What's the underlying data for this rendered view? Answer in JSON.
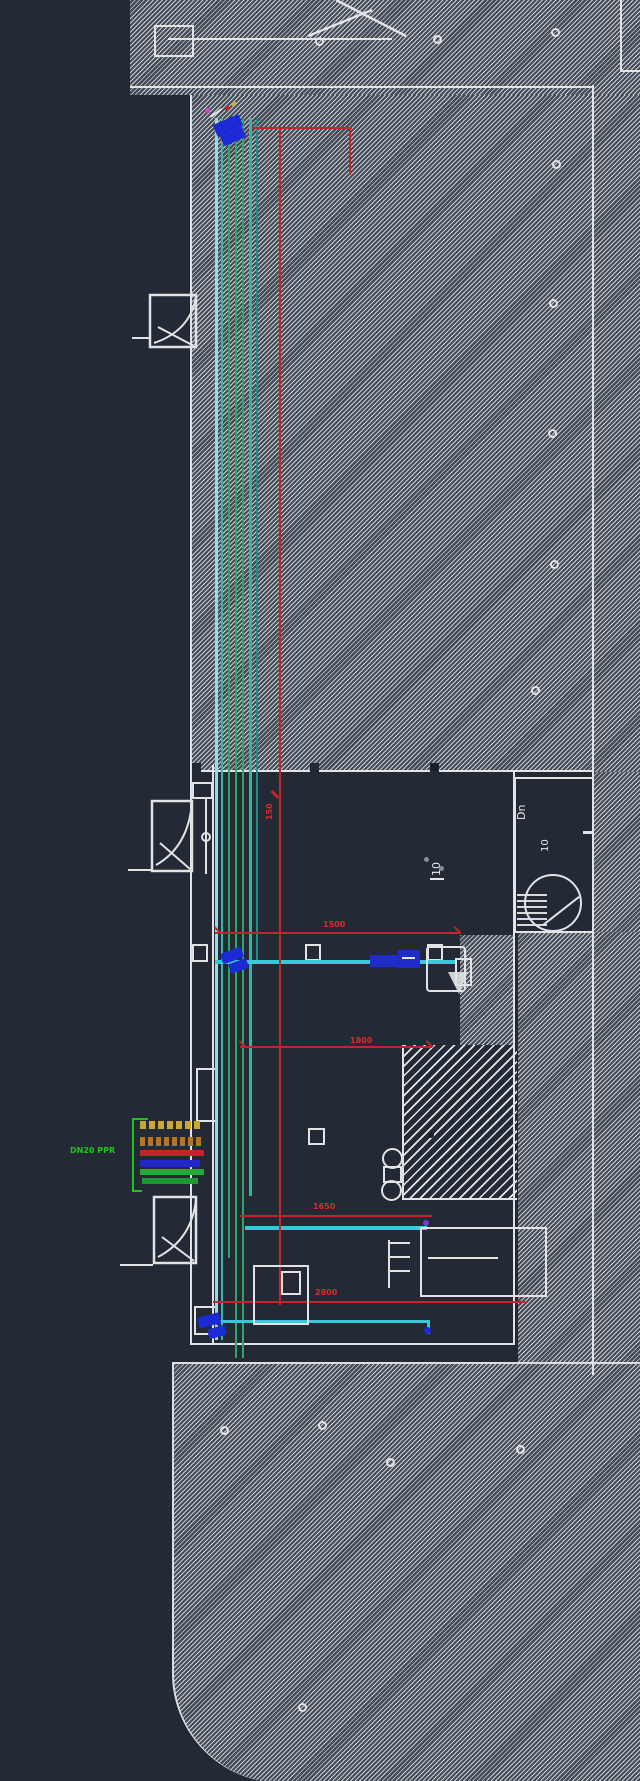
{
  "app": {
    "description": "CAD floor-plan drawing viewport (dark theme)",
    "background": "#232a35"
  },
  "colors": {
    "background": "#232a35",
    "linework_white": "#e2e3e5",
    "dimension_red": "#c3252b",
    "pipe_cyan": "#36c9da",
    "pipe_pale_cyan": "#8fdde8",
    "pipe_green": "#2fa763",
    "pipe_teal": "#2db89f",
    "arrow_blue": "#1b2ad4",
    "callout_green": "#1ec41e",
    "callout_yellow": "#c8a832"
  },
  "labels": {
    "stair_direction": "Dn",
    "stair_flight_count": "10",
    "room_riser_count": "10",
    "pipe_callout": "DN20 PPR"
  },
  "dims": {
    "vertical": "150",
    "mid": "1500",
    "shaft": "1800",
    "lower": "1650",
    "bottom": "2800"
  }
}
